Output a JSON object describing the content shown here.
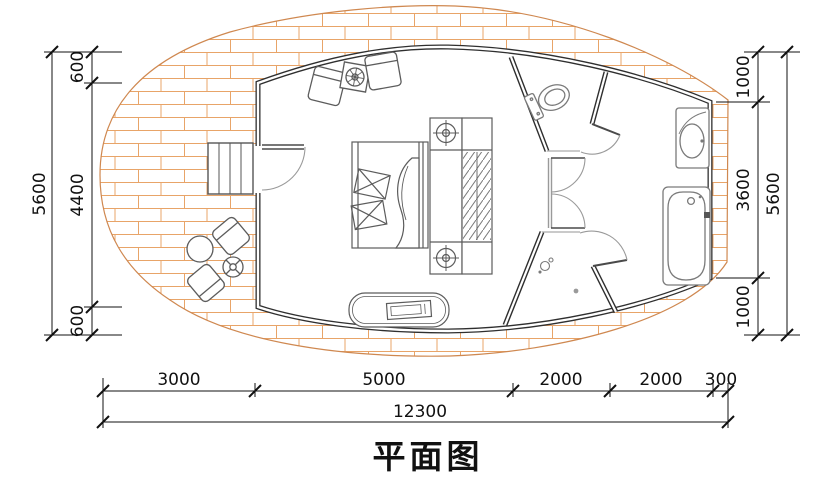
{
  "title": "平面图",
  "dims": {
    "left": {
      "total": "5600",
      "segments": [
        "600",
        "4400",
        "600"
      ]
    },
    "right": {
      "total": "5600",
      "segments": [
        "1000",
        "3600",
        "1000"
      ]
    },
    "bottom": {
      "segments": [
        "3000",
        "5000",
        "2000",
        "2000",
        "300"
      ],
      "total": "12300"
    }
  },
  "colors": {
    "wall": "#2f2f2f",
    "wood_hatch": "#e8a468",
    "furniture_line": "#6e6e6e",
    "dimension_line": "#111111"
  }
}
